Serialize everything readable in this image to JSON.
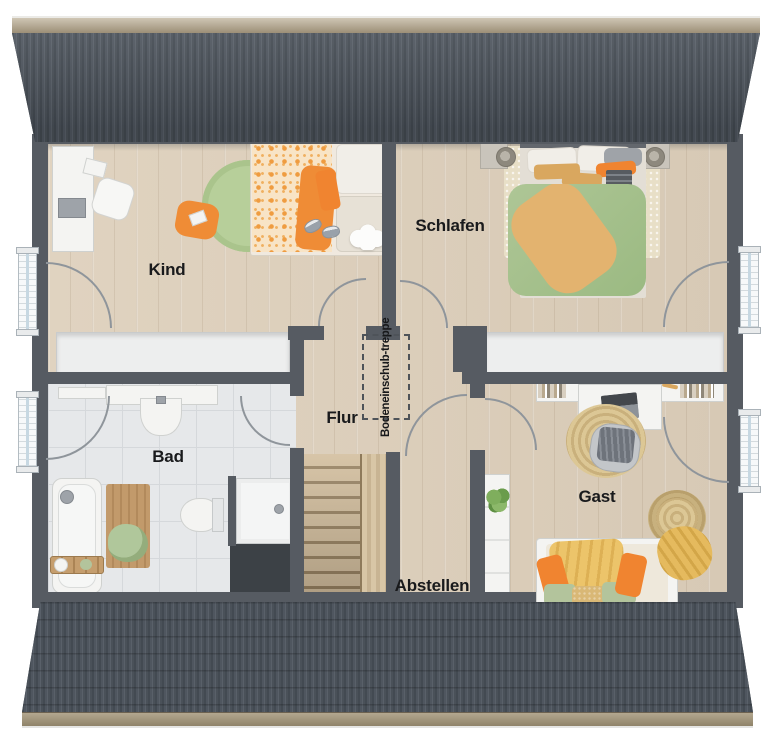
{
  "rooms": [
    {
      "id": "kind",
      "label": "Kind"
    },
    {
      "id": "schlafen",
      "label": "Schlafen"
    },
    {
      "id": "bad",
      "label": "Bad"
    },
    {
      "id": "flur",
      "label": "Flur"
    },
    {
      "id": "abstellen",
      "label": "Abstellen"
    },
    {
      "id": "gast",
      "label": "Gast"
    }
  ],
  "annotations": {
    "attic_hatch_line1": "Bodeneinschub-",
    "attic_hatch_line2": "treppe"
  },
  "colors": {
    "roof": "#4c535b",
    "ridge_wood": "#a89b83",
    "wall": "#565b62",
    "wood_floor": "#dbceba",
    "tile_floor": "#e6e8ea",
    "knee_storage_white": "#edeeee",
    "stair_wood": "#c7b292",
    "accent_orange": "#ef8c36",
    "accent_green": "#a9c390",
    "accent_tan": "#ddab64",
    "accent_sage": "#b3c49c"
  },
  "furniture": {
    "kind": [
      "desk",
      "office-chair",
      "laptop",
      "single-bed",
      "round-rug",
      "floor-cushion",
      "slippers",
      "cloud-rug"
    ],
    "schlafen": [
      "double-bed",
      "nightstand-left",
      "nightstand-right",
      "lamp-left",
      "lamp-right",
      "bedside-rug"
    ],
    "bad": [
      "vanity",
      "sink",
      "towel-rail",
      "bathtub",
      "bath-caddy",
      "wooden-mat",
      "towel",
      "toilet",
      "shower"
    ],
    "flur": [
      "attic-pull-down-stairs-hatch"
    ],
    "abstellen": [],
    "gast": [
      "desk",
      "laptop",
      "bookshelf-left",
      "bookshelf-right",
      "office-chair",
      "jute-rug",
      "shelf",
      "plant",
      "daybed",
      "basket-chair",
      "throw-blanket"
    ]
  }
}
